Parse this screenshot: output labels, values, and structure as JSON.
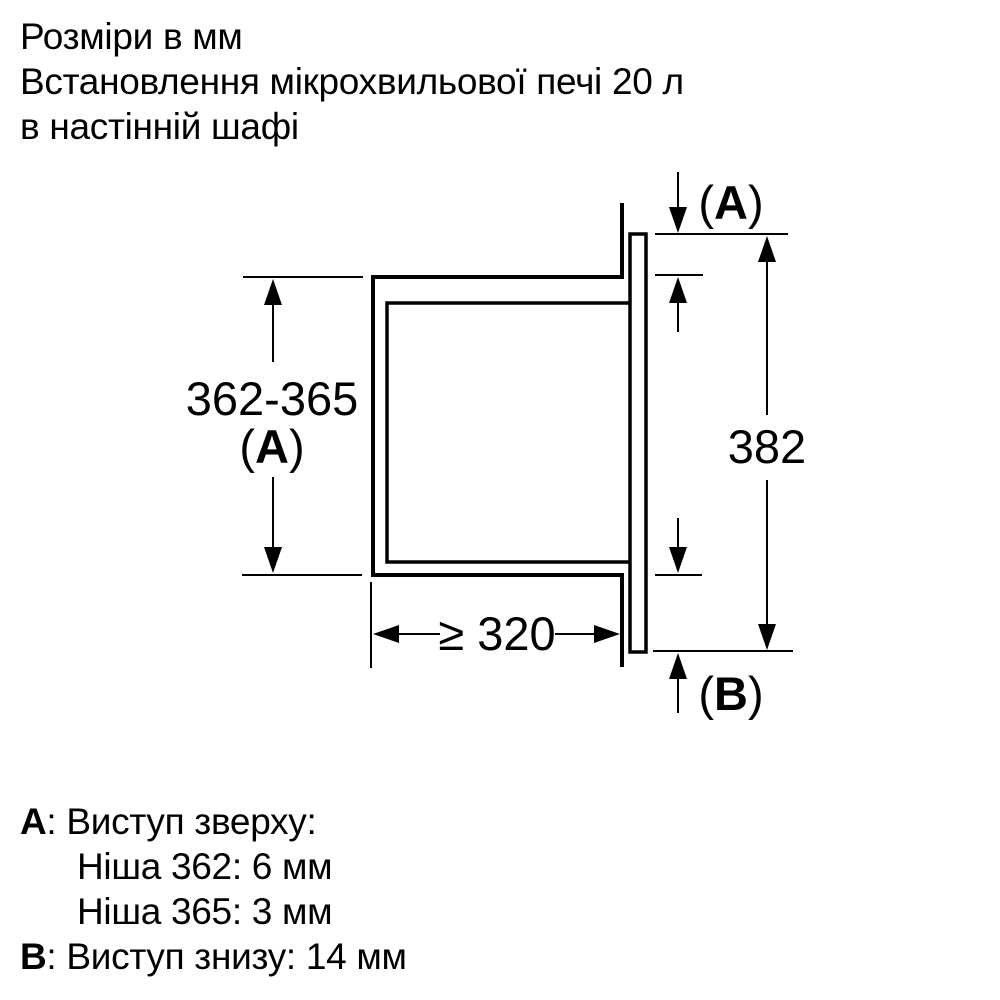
{
  "header": {
    "line1": "Розміри в мм",
    "line2": "Встановлення мікрохвильової печі 20 л",
    "line3": "в настінній шафі"
  },
  "diagram": {
    "dims": {
      "niche_height": "362-365",
      "front_height": "382",
      "depth": "≥ 320",
      "paren_open": "(",
      "paren_close": ")",
      "letter_a": "A",
      "letter_b": "B"
    }
  },
  "legend": {
    "a": {
      "letter": "A",
      "text": ": Виступ зверху:",
      "row1": "Ніша 362: 6 мм",
      "row2": "Ніша 365: 3 мм"
    },
    "b": {
      "letter": "B",
      "text": ": Виступ знизу: 14 мм"
    }
  }
}
